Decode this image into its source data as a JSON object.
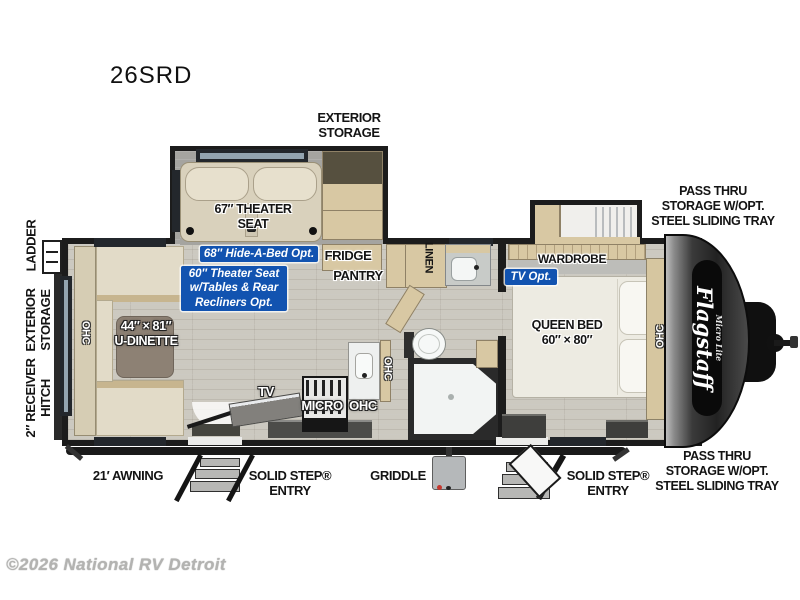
{
  "model": "26SRD",
  "watermark": "©2026 National RV Detroit",
  "brand": {
    "name": "Flagstaff",
    "sub": "Micro Lite"
  },
  "ext": {
    "storage_top": "EXTERIOR\nSTORAGE",
    "pass_thru_top": "PASS THRU\nSTORAGE W/OPT.\nSTEEL SLIDING TRAY",
    "pass_thru_bottom": "PASS THRU\nSTORAGE W/OPT.\nSTEEL SLIDING TRAY",
    "ladder": "LADDER",
    "storage_left": "EXTERIOR\nSTORAGE",
    "hitch": "2″ RECEIVER\nHITCH",
    "awning": "21′ AWNING",
    "entry_left": "SOLID STEP®\nENTRY",
    "entry_right": "SOLID STEP®\nENTRY",
    "griddle": "GRIDDLE"
  },
  "rooms": {
    "theater": "67″ THEATER\nSEAT",
    "dinette": "44″ × 81″\nU-DINETTE",
    "queen_bed": "QUEEN BED\n60″ × 80″",
    "fridge": "FRIDGE",
    "pantry": "PANTRY",
    "linen": "LINEN",
    "wardrobe": "WARDROBE",
    "tv": "TV",
    "micro": "MICRO",
    "ohc_micro": "OHC",
    "ohc_dinette": "OHC",
    "ohc_kitchen": "OHC",
    "ohc_bedroom": "OHC"
  },
  "opts": {
    "hide_a_bed": "68″ Hide-A-Bed Opt.",
    "theater": "60″ Theater Seat\nw/Tables & Rear\nRecliners Opt.",
    "tv": "TV Opt."
  },
  "colors": {
    "badge_blue": "#1253b0",
    "wall": "#1c1c1c",
    "floor": "#ccc9c0",
    "slide_floor": "#a5a4a0",
    "wood": "#d8c8a3",
    "cushion": "#e2dbc8",
    "bed": "#edebe2"
  }
}
